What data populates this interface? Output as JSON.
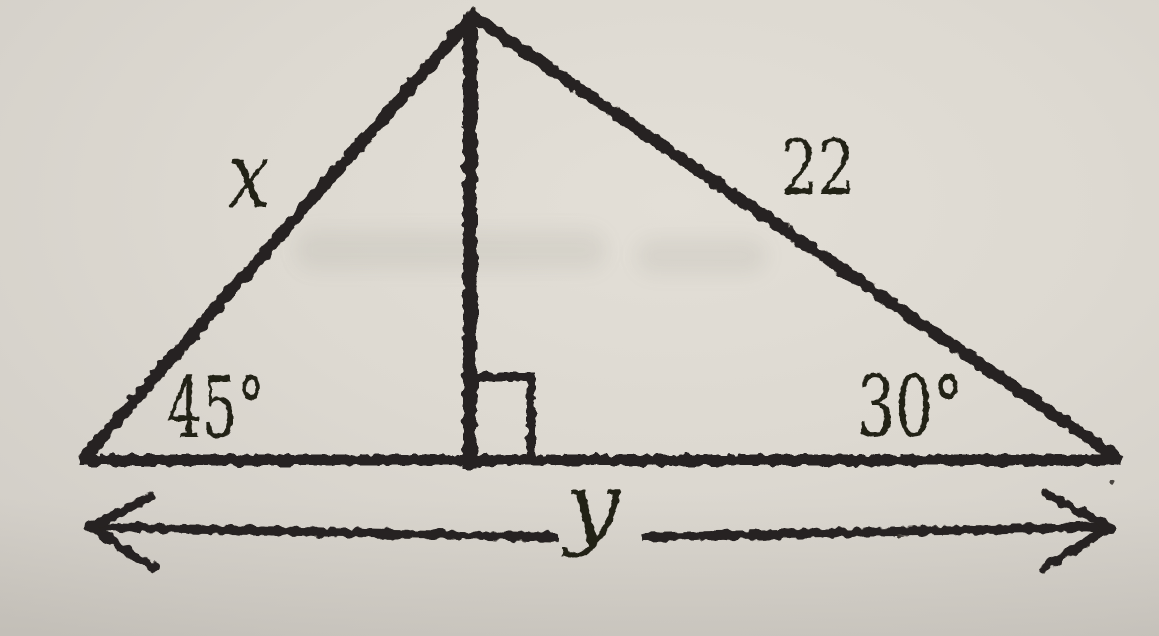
{
  "figure": {
    "kind": "triangle-with-altitude",
    "labels": {
      "left_side": "x",
      "right_side": "22",
      "left_base_angle": "45°",
      "right_base_angle": "30°",
      "base_dimension": "y"
    },
    "colors": {
      "ink": "#282420",
      "paper": "#dcd8d0"
    }
  }
}
